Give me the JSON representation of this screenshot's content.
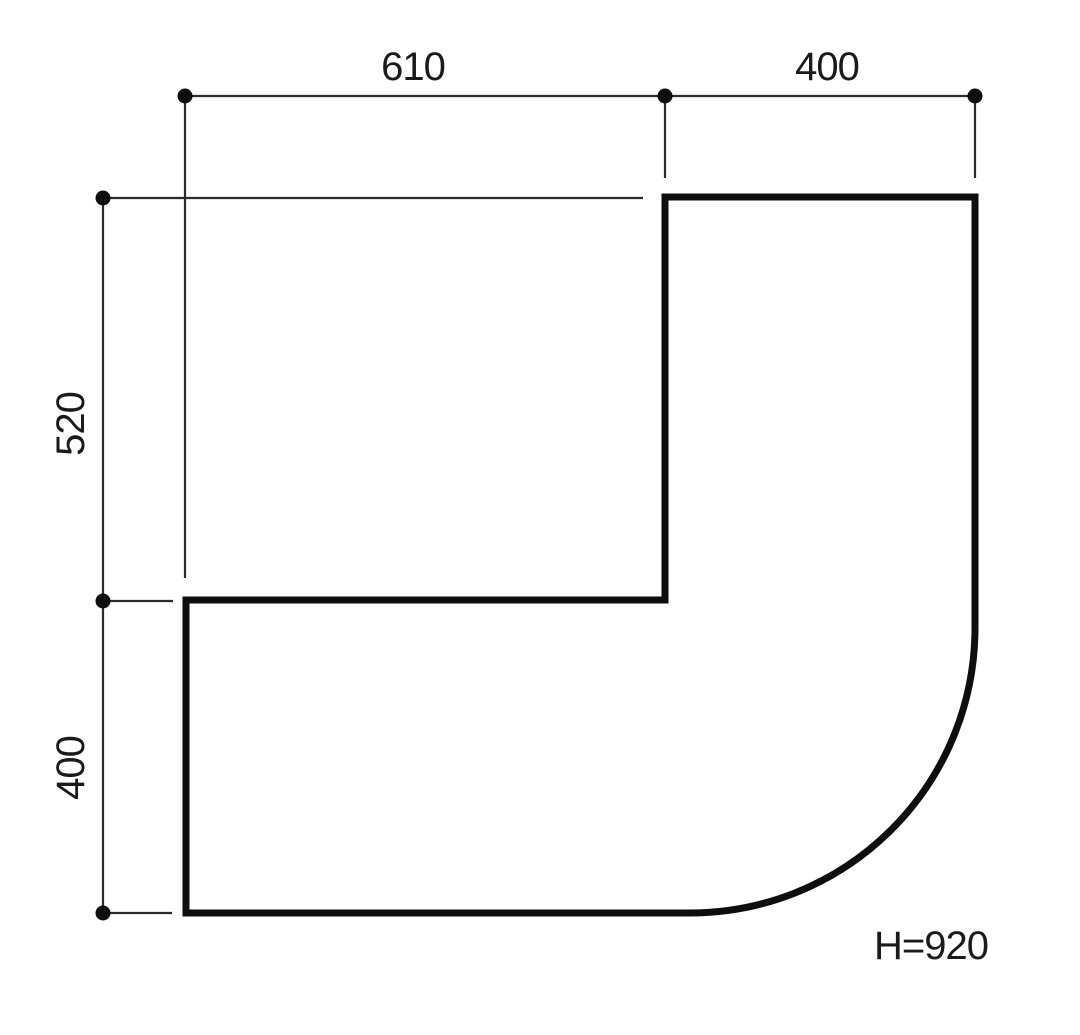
{
  "drawing": {
    "type": "technical-dimension-drawing",
    "shape": "corner-worktop-plan-with-rounded-outer-corner",
    "labels": {
      "top_width_left": "610",
      "top_width_right": "400",
      "side_height_upper": "520",
      "side_height_lower": "400",
      "height_note": "H=920"
    },
    "dimensions": [
      {
        "value": 610,
        "edge": "top",
        "segment": "left"
      },
      {
        "value": 400,
        "edge": "top",
        "segment": "right"
      },
      {
        "value": 520,
        "edge": "left",
        "segment": "upper"
      },
      {
        "value": 400,
        "edge": "left",
        "segment": "lower"
      },
      {
        "value": 920,
        "name": "H",
        "note": "overall height"
      }
    ],
    "colors": {
      "outline": "#0e0e0e",
      "dimension": "#2b2b2b",
      "text": "#1a1a1a",
      "background": "#ffffff"
    }
  }
}
